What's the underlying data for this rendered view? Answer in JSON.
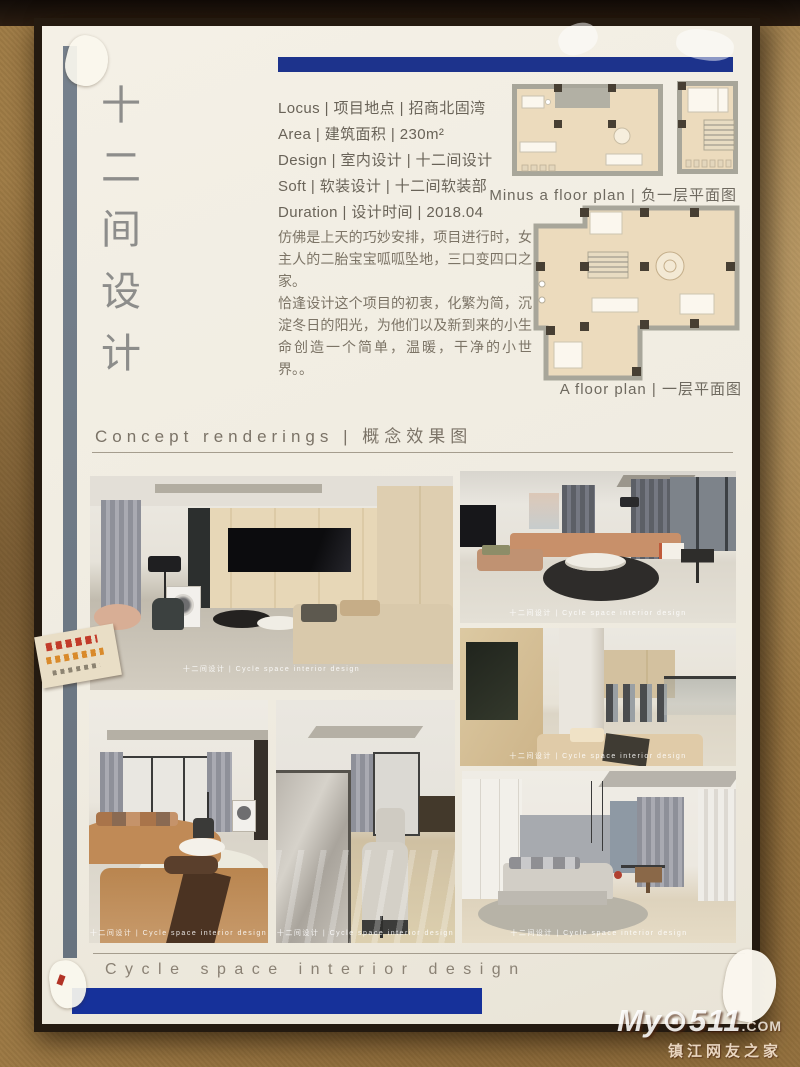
{
  "poster": {
    "vertical_title": "十二间设计",
    "accent_navy": "#16319a",
    "accent_slate": "#6e7987",
    "info_lines": [
      "Locus | 项目地点 | 招商北固湾",
      "Area | 建筑面积 | 230m²",
      "Design | 室内设计 | 十二间设计",
      "Soft  | 软装设计 | 十二间软装部",
      "Duration  | 设计时间 | 2018.04"
    ],
    "intro": {
      "para1": "仿佛是上天的巧妙安排，项目进行时，女主人的二胎宝宝呱呱坠地，三口变四口之家。",
      "para2": "恰逢设计这个项目的初衷，化繁为简，沉淀冬日的阳光，为他们以及新到来的小生命创造一个简单，温暖，干净的小世界。。"
    },
    "floor_plans": {
      "minus_caption": "Minus a floor plan | 负一层平面图",
      "a_caption": "A floor plan | 一层平面图"
    },
    "concept_heading": "Concept renderings | 概念效果图",
    "bottom_heading": "Cycle space interior design",
    "photo_watermark": "十二间设计 | Cycle space interior design"
  },
  "site_watermark": {
    "logo_main": "My⊙511",
    "logo_suffix": ".COM",
    "subtitle": "镇江网友之家"
  }
}
